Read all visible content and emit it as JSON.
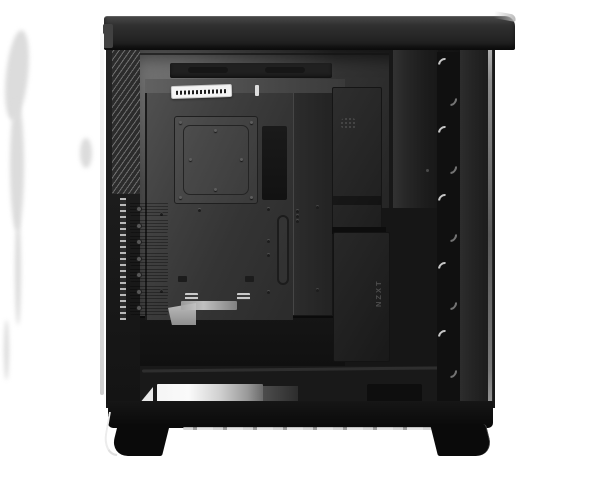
{
  "scene": {
    "type": "product-photo",
    "subject": "Black mid-tower PC case, side view with tempered glass edge visible, showing interior motherboard tray, rear vents, PCI slots and front fan column",
    "background_color": "#ffffff"
  },
  "branding": {
    "vertical_logo_text": "NZXT"
  },
  "case_features": {
    "pci_slot_count": 7,
    "fan_highlight_count": 10,
    "has_spec_sticker": true,
    "sticker_legible": false
  },
  "colors": {
    "case_black": "#0d0d0d",
    "panel_gray": "#2e2e2e",
    "interior_highlight": "#5a5a5a",
    "glass_edge": "#f0f0f0",
    "reflection_white": "#f5f5f5",
    "logo_gray": "#4e4e4e"
  }
}
